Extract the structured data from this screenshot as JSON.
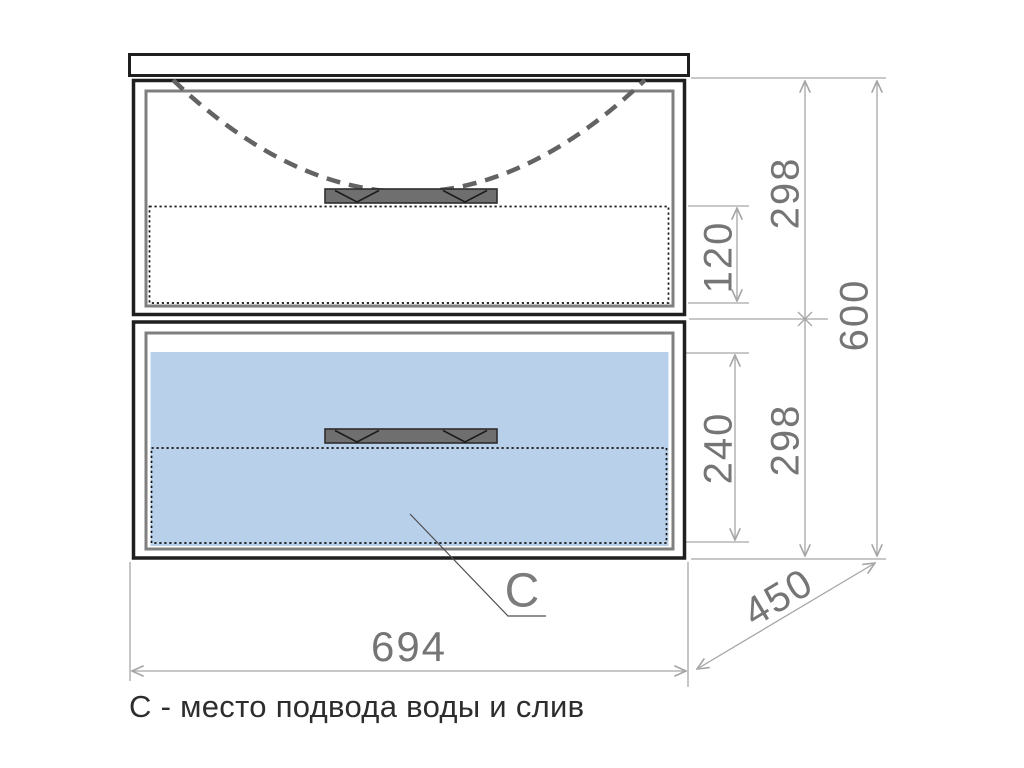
{
  "colors": {
    "outline": "#1f1f1f",
    "inner_frame": "#7f7f7f",
    "sink_dash": "#636363",
    "drawer_highlight": "#b8d0ea",
    "handle_fill": "#6f6f6f",
    "dim_line": "#a6a6a6",
    "dim_text": "#757575",
    "caption_text": "#2d2d2d"
  },
  "dimensions": {
    "cabinet_width": "694",
    "cabinet_depth": "450",
    "cabinet_height": "600",
    "top_drawer_height": "298",
    "bottom_drawer_height": "298",
    "top_drawer_inner_depth": "120",
    "bottom_drawer_inner_depth": "240"
  },
  "labels": {
    "connection_point": "С",
    "caption": "С - место подвода воды и слив"
  }
}
